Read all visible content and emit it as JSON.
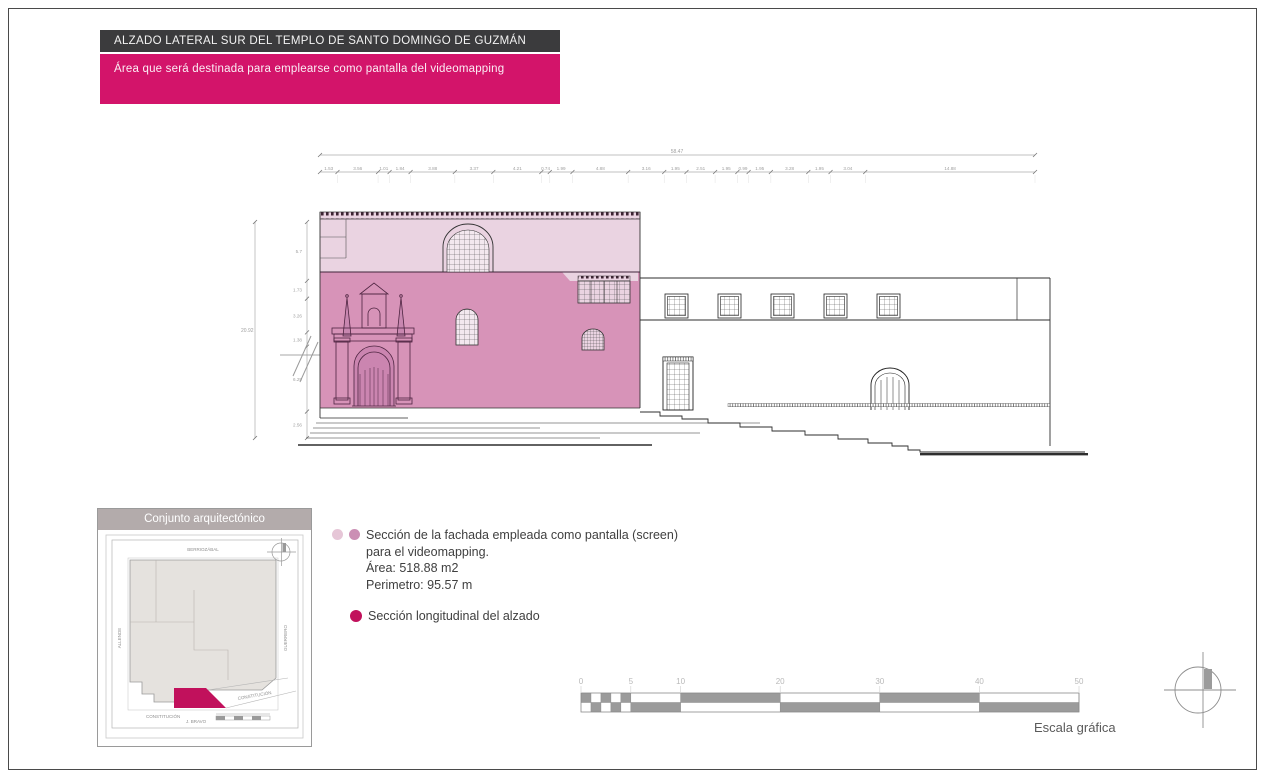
{
  "header": {
    "title": "ALZADO LATERAL SUR DEL TEMPLO DE SANTO DOMINGO DE GUZMÁN",
    "subtitle": "Área que será destinada para emplearse como pantalla del videomapping"
  },
  "colors": {
    "title_bg": "#3b3b3d",
    "subtitle_bg": "#d3146a",
    "screen_light": "#ead3e1",
    "screen_mid": "#d793b8",
    "accent_magenta": "#c1115c",
    "legend_dot_light": "#e6c6d7",
    "legend_dot_mid": "#cb8fb4",
    "plan_gray": "#e5e2de",
    "scale_gray": "#9b9b9b"
  },
  "dimensions": {
    "overall_width": "58.47",
    "width_segments": [
      "1.53",
      "3.56",
      "1.01",
      "1.84",
      "3.88",
      "3.37",
      "4.21",
      "0.74",
      "1.99",
      "4.88",
      "3.16",
      "1.95",
      "2.51",
      "1.95",
      "0.99",
      "1.95",
      "3.28",
      "1.95",
      "3.04",
      "14.88"
    ],
    "overall_height": "20.92",
    "height_segments": [
      "5.70",
      "1.73",
      "3.26",
      "1.38",
      "6.29",
      "2.56"
    ]
  },
  "legend": {
    "item1": {
      "line1": "Sección de la fachada empleada  como pantalla (screen)",
      "line2": "para el videomapping.",
      "area": "Área: 518.88 m2",
      "perimeter": "Perimetro: 95.57 m"
    },
    "item2": {
      "label": "Sección longitudinal del alzado"
    }
  },
  "site_plan": {
    "title": "Conjunto arquitectónico",
    "streets": {
      "top": "BERRIOZÁBAL",
      "left": "ALLENDE",
      "right": "GUERRERO",
      "bottom_left": "CONSTITUCIÓN",
      "bottom_center": "J. BRAVO",
      "diagonal": "CONSTITUCIÓN"
    }
  },
  "scale_bar": {
    "ticks": [
      "0",
      "5",
      "10",
      "20",
      "30",
      "40",
      "50"
    ],
    "label": "Escala gráfica"
  }
}
